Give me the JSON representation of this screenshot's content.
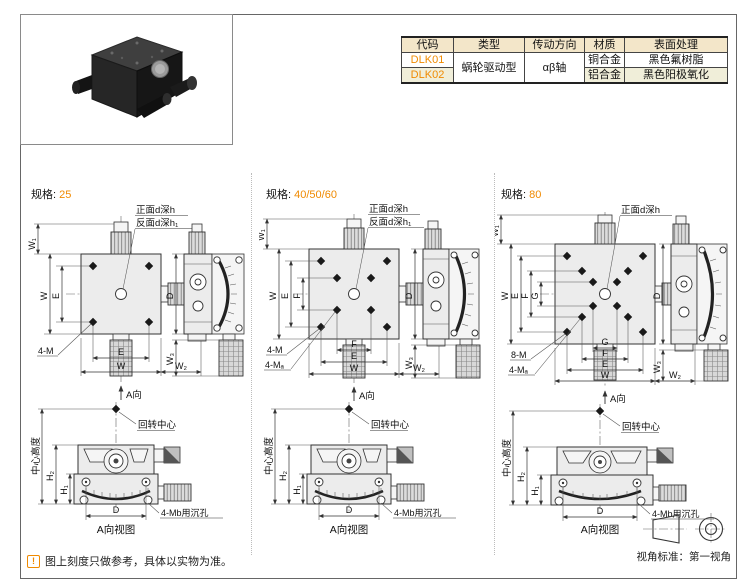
{
  "colors": {
    "accent": "#F08A00",
    "table_header_bg": "#F3E6C9",
    "table_alt_row_bg": "#F0EED9",
    "drawing_fill": "#ECECEC"
  },
  "product_table": {
    "headers": [
      "代码",
      "类型",
      "传动方向",
      "材质",
      "表面处理"
    ],
    "type": "蜗轮驱动型",
    "direction": "αβ轴",
    "rows": [
      {
        "code": "DLK01",
        "material": "铜合金",
        "finish": "黑色氟树脂"
      },
      {
        "code": "DLK02",
        "material": "铝合金",
        "finish": "黑色阳极氧化"
      }
    ]
  },
  "specs": [
    {
      "label": "规格:",
      "value": "25",
      "front_hole": "正面d深h",
      "back_hole": "反面d深h₁",
      "tap_outer": "4-M",
      "dim_w1": "W₁",
      "dim_w": "W",
      "dim_e": "E",
      "bdim_e": "E",
      "bdim_w": "W",
      "bdim_w2": "W₂",
      "a_dir": "A向",
      "side_d": "D",
      "side_w3": "W₃",
      "center_height": "中心高度",
      "rotation_center": "回转中心",
      "dim_h2": "H₂",
      "dim_h1": "H₁",
      "dim_d": "D",
      "counterbore": "4-Mb用沉孔",
      "caption": "A向视图"
    },
    {
      "label": "规格:",
      "value": "40/50/60",
      "front_hole": "正面d深h",
      "back_hole": "反面d深h₁",
      "tap_outer": "4-M",
      "tap_inner": "4-Mₐ",
      "dim_w1": "W₁",
      "dim_w": "W",
      "dim_e": "E",
      "dim_f": "F",
      "bdim_f": "F",
      "bdim_e": "E",
      "bdim_w": "W",
      "bdim_w2": "W₂",
      "a_dir": "A向",
      "side_d": "D",
      "side_w3": "W₃",
      "center_height": "中心高度",
      "rotation_center": "回转中心",
      "dim_h2": "H₂",
      "dim_h1": "H₁",
      "dim_d": "D",
      "counterbore": "4-Mb用沉孔",
      "caption": "A向视图"
    },
    {
      "label": "规格:",
      "value": "80",
      "front_hole": "正面d深h",
      "tap_outer": "8-M",
      "tap_inner": "4-Mₐ",
      "dim_w1": "W₁",
      "dim_w": "W",
      "dim_e": "E",
      "dim_f": "F",
      "dim_g": "G",
      "bdim_g": "G",
      "bdim_f": "F",
      "bdim_e": "E",
      "bdim_w": "W",
      "bdim_w2": "W₂",
      "a_dir": "A向",
      "side_d": "D",
      "side_w3": "W₃",
      "center_height": "中心高度",
      "rotation_center": "回转中心",
      "dim_h2": "H₂",
      "dim_h1": "H₁",
      "dim_d": "D",
      "counterbore": "4-Mb用沉孔",
      "caption": "A向视图"
    }
  ],
  "footer": {
    "note_icon": "!",
    "note": "图上刻度只做参考，具体以实物为准。",
    "view_standard": "视角标准：第一视角"
  }
}
